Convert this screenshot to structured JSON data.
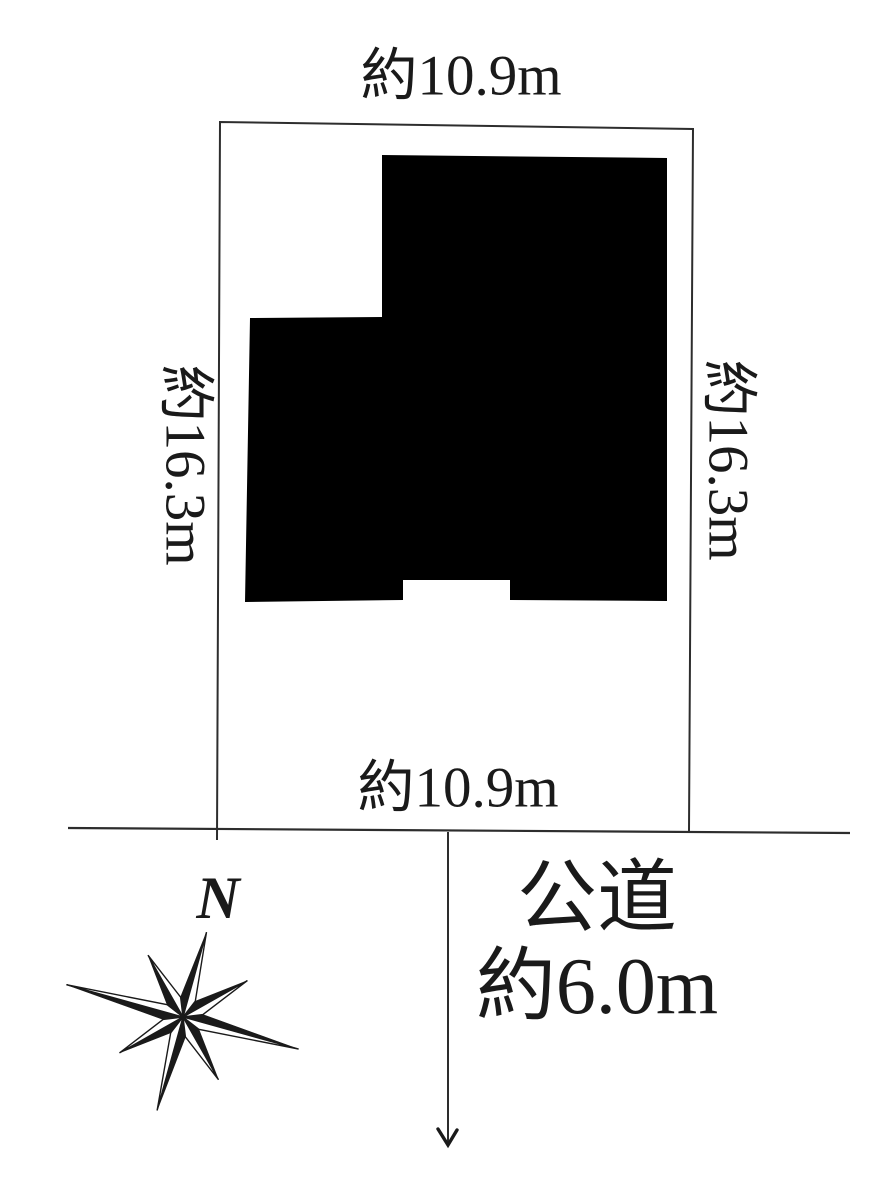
{
  "diagram": {
    "kind": "land-plot-site-plan"
  },
  "dimensions": {
    "top": "約10.9m",
    "bottom": "約10.9m",
    "left": "約16.3m",
    "right": "約16.3m"
  },
  "road": {
    "name": "公道",
    "width": "約6.0m"
  },
  "compass": {
    "label": "N"
  },
  "colors": {
    "ink": "#1a1a1a",
    "line": "#2d2d2d",
    "building": "#000000",
    "background": "#ffffff"
  }
}
